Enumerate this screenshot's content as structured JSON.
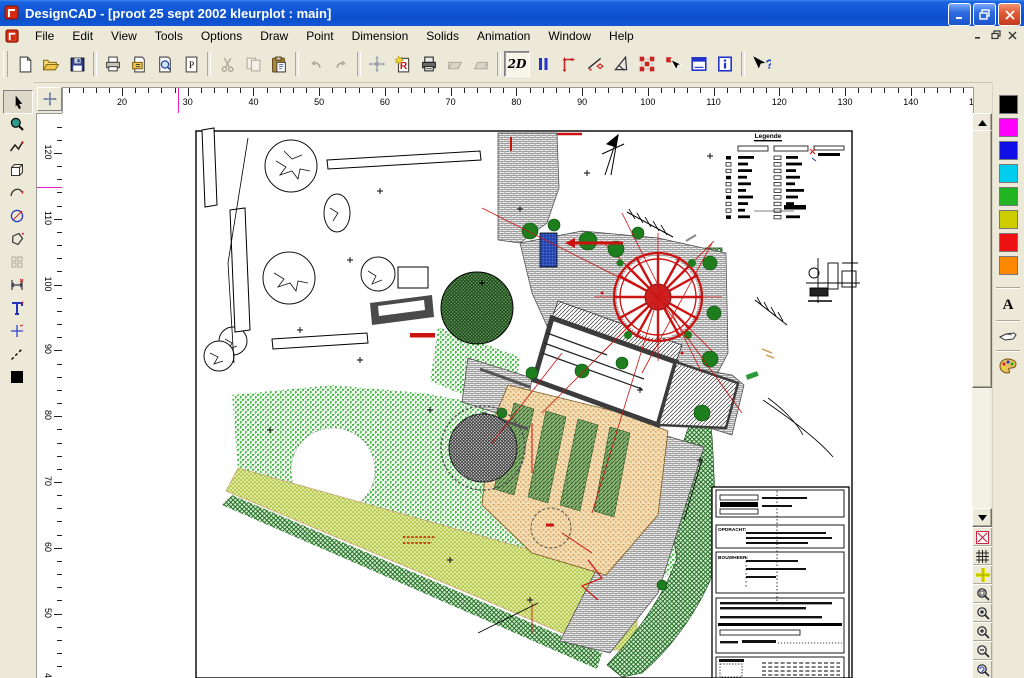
{
  "window": {
    "title": "DesignCAD - [proot 25 sept 2002 kleurplot : main]"
  },
  "menu": {
    "items": [
      "File",
      "Edit",
      "View",
      "Tools",
      "Options",
      "Draw",
      "Point",
      "Dimension",
      "Solids",
      "Animation",
      "Window",
      "Help"
    ]
  },
  "toolbar": {
    "two_d_label": "2D",
    "p_icon_label": "P",
    "r_icon_label": "R",
    "help_label": "?"
  },
  "rulers": {
    "top_labels": [
      20,
      30,
      40,
      50,
      60,
      70,
      80,
      90,
      100,
      110,
      120,
      130,
      140,
      150
    ],
    "left_labels": [
      120,
      110,
      100,
      90,
      80,
      70,
      60,
      50,
      40
    ]
  },
  "color_palette": {
    "colors": [
      "#000000",
      "#ff00ff",
      "#0f0fe6",
      "#00ccee",
      "#22b422",
      "#cccc00",
      "#ee1111",
      "#ff8800"
    ],
    "text_button_label": "A"
  },
  "drawing": {
    "legend_title": "Legende",
    "title_block": {
      "client_label": "OPDRACHT:",
      "owner_label": "BOUWHEER:"
    }
  }
}
